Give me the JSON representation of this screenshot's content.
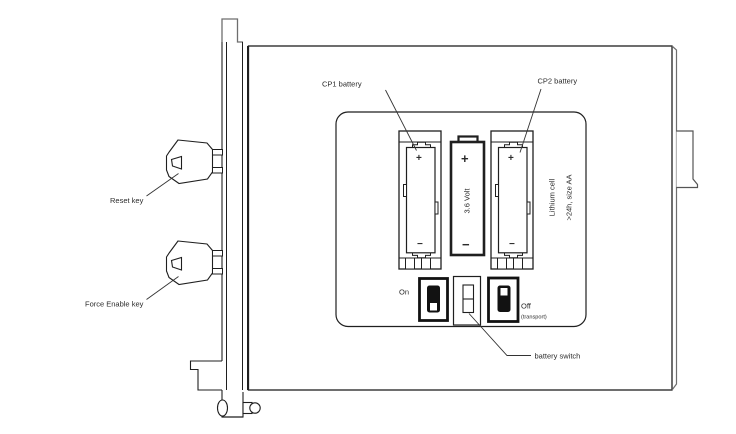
{
  "diagram": {
    "title": "battery compartment diagram",
    "labels": {
      "cp1_battery": "CP1 battery",
      "cp2_battery": "CP2 battery",
      "reset_key": "Reset key",
      "force_enable_key": "Force Enable key",
      "battery_switch": "battery switch",
      "switch_on": "On",
      "switch_off": "Off",
      "switch_off_sub": "(transport)",
      "center_battery_voltage": "3.6 Volt",
      "cell_type": "Lithium cell",
      "cell_spec": ">24h, size AA",
      "plus": "+",
      "minus": "−"
    },
    "colors": {
      "line": "#1f1f1f",
      "shadow_line": "#6e6e6e",
      "toggle_fill": "#121212",
      "background": "#ffffff"
    }
  }
}
